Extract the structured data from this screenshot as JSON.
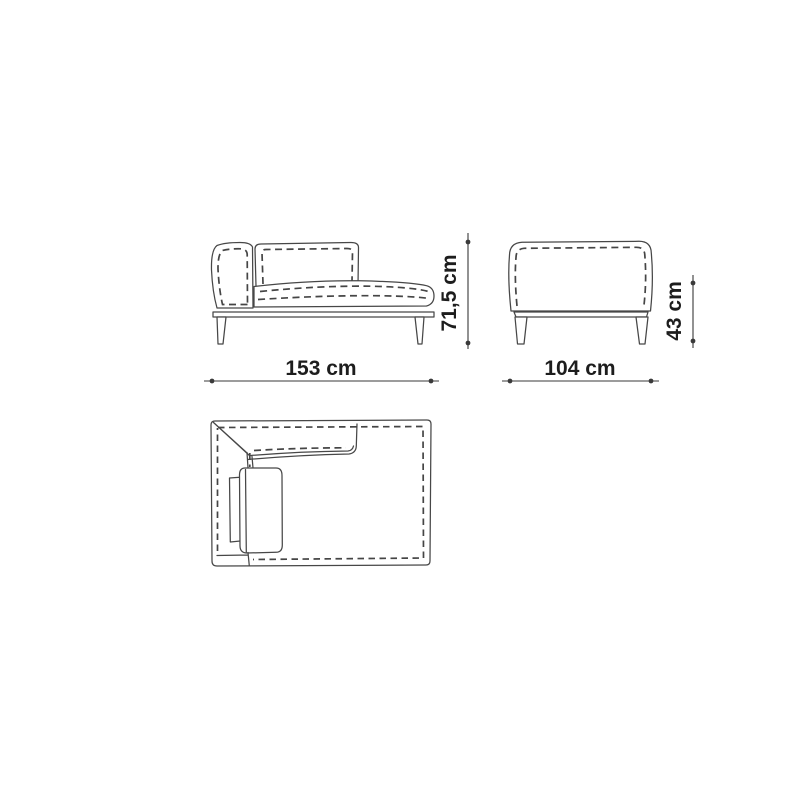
{
  "canvas": {
    "background": "#ffffff",
    "line_color": "#474747",
    "dimension_line_color": "#3a3a3a",
    "text_color": "#1d1d1d"
  },
  "dimensions": {
    "front_width": "153 cm",
    "overall_height": "71,5 cm",
    "depth": "104 cm",
    "seat_height": "43 cm"
  }
}
